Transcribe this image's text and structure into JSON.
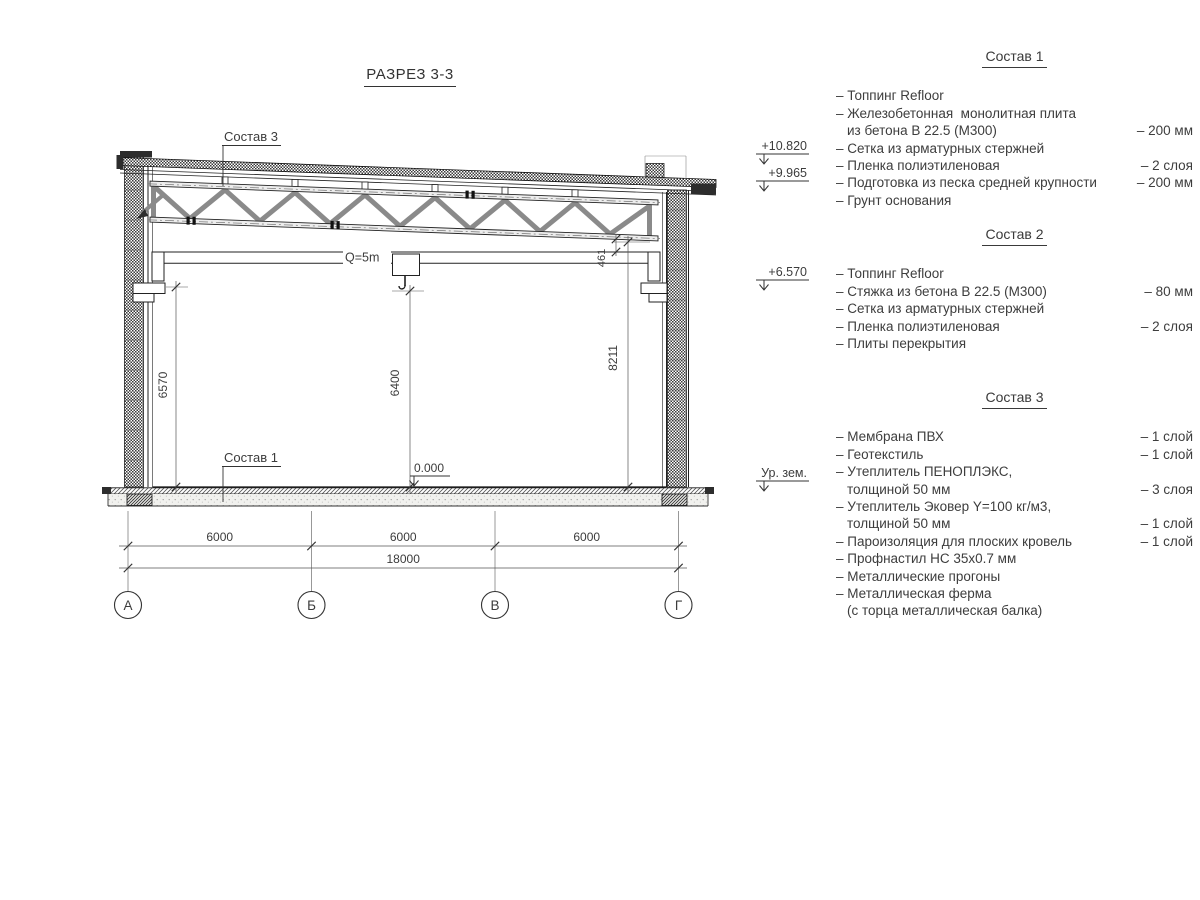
{
  "title": "РАЗРЕЗ 3-3",
  "drawing": {
    "callouts": {
      "roof": "Состав 3",
      "floor": "Состав 1",
      "crane_capacity": "Q=5m"
    },
    "elevations": {
      "parapet": "+10.820",
      "roof_low": "+9.965",
      "crane_rail": "+6.570",
      "ground": "Ур. зем.",
      "zero": "0.000"
    },
    "dims": {
      "left_height": "6570",
      "hook_height": "6400",
      "right_height": "8211",
      "truss_gap": "461",
      "span1": "6000",
      "span2": "6000",
      "span3": "6000",
      "total": "18000"
    },
    "axes": {
      "a": "А",
      "b": "Б",
      "c": "В",
      "d": "Г"
    }
  },
  "compositions": [
    {
      "title": "Состав 1",
      "items": [
        {
          "lines": [
            "– Топпинг Refloor"
          ],
          "value": ""
        },
        {
          "lines": [
            "– Железобетонная  монолитная плита",
            "из бетона В 22.5 (М300)"
          ],
          "value": "– 200 мм"
        },
        {
          "lines": [
            "– Сетка из арматурных стержней"
          ],
          "value": ""
        },
        {
          "lines": [
            "– Пленка полиэтиленовая"
          ],
          "value": "– 2 слоя"
        },
        {
          "lines": [
            "– Подготовка из песка средней крупности"
          ],
          "value": "– 200 мм"
        },
        {
          "lines": [
            "– Грунт основания"
          ],
          "value": ""
        }
      ]
    },
    {
      "title": "Состав 2",
      "items": [
        {
          "lines": [
            "– Топпинг Refloor"
          ],
          "value": ""
        },
        {
          "lines": [
            "– Стяжка из бетона В 22.5 (М300)"
          ],
          "value": "– 80 мм"
        },
        {
          "lines": [
            "– Сетка из арматурных стержней"
          ],
          "value": ""
        },
        {
          "lines": [
            "– Пленка полиэтиленовая"
          ],
          "value": "– 2 слоя"
        },
        {
          "lines": [
            "– Плиты перекрытия"
          ],
          "value": ""
        }
      ]
    },
    {
      "title": "Состав 3",
      "items": [
        {
          "lines": [
            "– Мембрана ПВХ"
          ],
          "value": "– 1 слой"
        },
        {
          "lines": [
            "– Геотекстиль"
          ],
          "value": "– 1 слой"
        },
        {
          "lines": [
            "– Утеплитель ПЕНОПЛЭКС,",
            "толщиной 50 мм"
          ],
          "value": "– 3 слоя"
        },
        {
          "lines": [
            "– Утеплитель Эковер Y=100 кг/м3,",
            "толщиной 50 мм"
          ],
          "value": "– 1 слой"
        },
        {
          "lines": [
            "– Пароизоляция для плоских кровель"
          ],
          "value": "– 1 слой"
        },
        {
          "lines": [
            "– Профнастил НС 35х0.7 мм"
          ],
          "value": ""
        },
        {
          "lines": [
            "– Металлические прогоны"
          ],
          "value": ""
        },
        {
          "lines": [
            "– Металлическая ферма",
            "(с торца металлическая балка)"
          ],
          "value": ""
        }
      ]
    }
  ]
}
